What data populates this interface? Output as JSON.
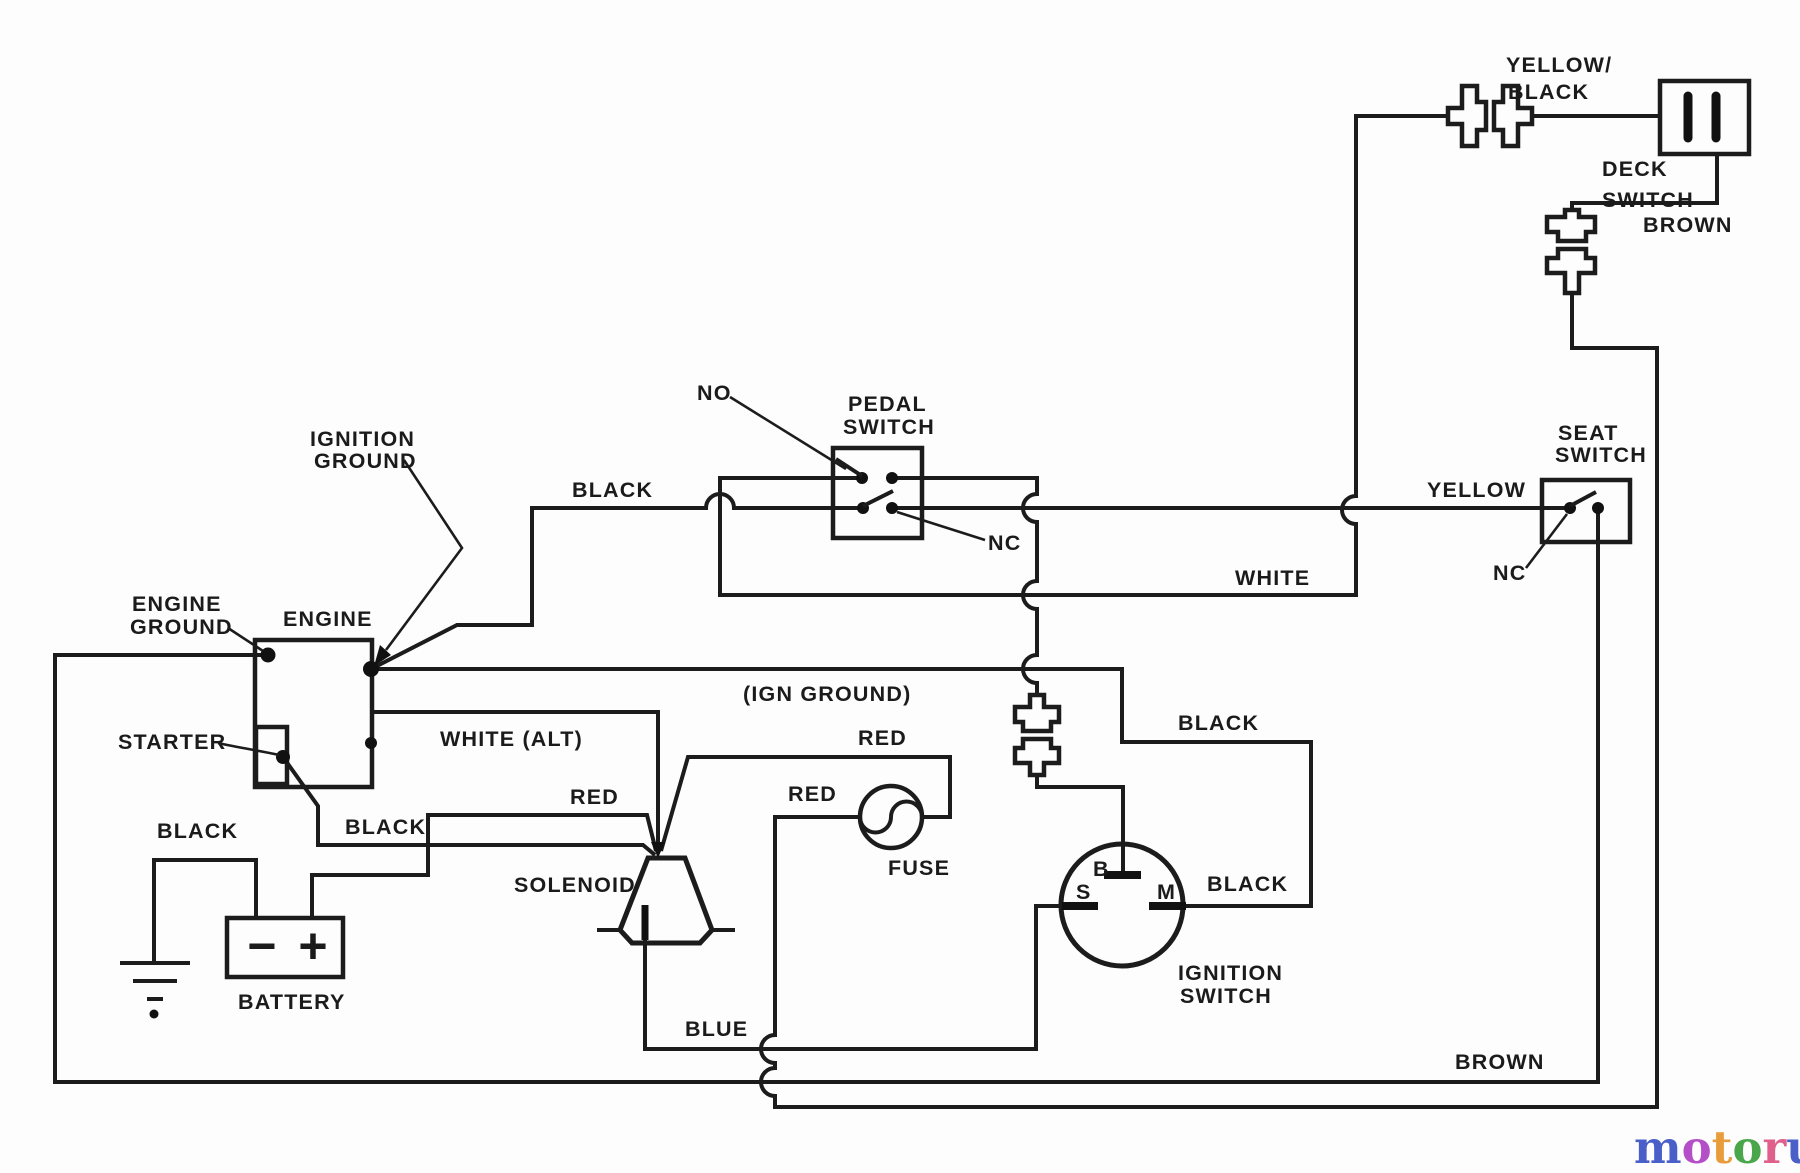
{
  "labels": {
    "yellow_black": [
      "YELLOW/",
      "BLACK"
    ],
    "deck_switch": [
      "DECK",
      "SWITCH"
    ],
    "brown_top": "BROWN",
    "no_pedal": "NO",
    "pedal_switch": [
      "PEDAL",
      "SWITCH"
    ],
    "black_pedal": "BLACK",
    "nc_pedal": "NC",
    "yellow": "YELLOW",
    "seat_switch": [
      "SEAT",
      "SWITCH"
    ],
    "nc_seat": "NC",
    "white": "WHITE",
    "ignition_ground": [
      "IGNITION",
      "GROUND"
    ],
    "engine_ground": [
      "ENGINE",
      "GROUND"
    ],
    "engine": "ENGINE",
    "ign_ground_inline": "(IGN GROUND)",
    "white_alt": "WHITE (ALT)",
    "starter": "STARTER",
    "red_top": "RED",
    "red_fuse_left": "RED",
    "red_battery": "RED",
    "fuse": "FUSE",
    "black_starter": "BLACK",
    "black_battery": "BLACK",
    "solenoid": "SOLENOID",
    "battery": "BATTERY",
    "battery_minus": "−",
    "battery_plus": "+",
    "blue": "BLUE",
    "black_magneto_upper": "BLACK",
    "black_magneto": "BLACK",
    "ignition_switch": [
      "IGNITION",
      "SWITCH"
    ],
    "terminal_b": "B",
    "terminal_s": "S",
    "terminal_m": "M",
    "brown_bottom": "BROWN"
  },
  "logo": {
    "letters": [
      {
        "char": "m",
        "color": "#4a5fc8"
      },
      {
        "char": "o",
        "color": "#b44fc8"
      },
      {
        "char": "t",
        "color": "#e89c3c"
      },
      {
        "char": "o",
        "color": "#4aa64a"
      },
      {
        "char": "r",
        "color": "#e0608c"
      },
      {
        "char": "u",
        "color": "#4a5fc8"
      },
      {
        "char": "f",
        "color": "#e8bc3c"
      }
    ],
    "mark": "”",
    "tld": ".de"
  },
  "colors": {
    "line": "#1c1c1c",
    "background": "#fdfdfd",
    "logo_tld": "#8d8d8d"
  }
}
